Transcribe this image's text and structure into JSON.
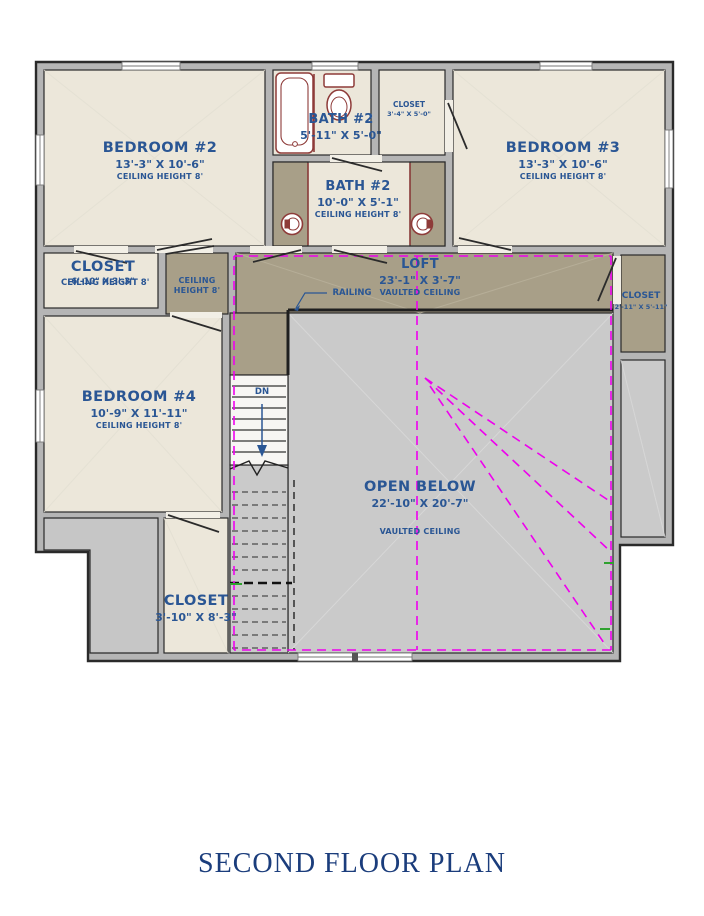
{
  "title": "SECOND FLOOR PLAN",
  "colors": {
    "wall_fill": "#B5B5B5",
    "wall_stroke": "#2A2A2A",
    "room_cream": "#ECE7DA",
    "loft_brown": "#A89F88",
    "open_gray": "#CACACA",
    "label_blue": "#2A5694",
    "title_blue": "#1B3D7C",
    "vault_magenta": "#EE00EE",
    "fixture_red": "#8E3B39",
    "mark_green": "#2FA12F"
  },
  "rooms": {
    "bedroom2": {
      "name": "BEDROOM #2",
      "dims": "13'-3\" X 10'-6\"",
      "ceiling": "CEILING HEIGHT 8'"
    },
    "bath2_upper": {
      "name": "BATH #2",
      "dims": "5'-11\" X 5'-0\""
    },
    "closet_upper": {
      "name": "CLOSET",
      "dims": "3'-4\" X 5'-0\""
    },
    "bedroom3": {
      "name": "BEDROOM #3",
      "dims": "13'-3\" X 10'-6\"",
      "ceiling": "CEILING HEIGHT 8'"
    },
    "bath2_main": {
      "name": "BATH #2",
      "dims": "10'-0\" X 5'-1\"",
      "ceiling": "CEILING HEIGHT 8'"
    },
    "closet_left": {
      "name": "CLOSET",
      "dims": "6'-10\" X 3'-3\"",
      "ceiling": "CEILING HEIGHT 8'"
    },
    "hallway": {
      "line1": "CEILING",
      "line2": "HEIGHT 8'"
    },
    "loft": {
      "name": "LOFT",
      "dims": "23'-1\" X 3'-7\"",
      "ceiling": "VAULTED CEILING"
    },
    "closet_right": {
      "name": "CLOSET",
      "dims": "2'-11\" X 5'-11\""
    },
    "bedroom4": {
      "name": "BEDROOM #4",
      "dims": "10'-9\" X 11'-11\"",
      "ceiling": "CEILING HEIGHT 8'"
    },
    "open_below": {
      "name": "OPEN BELOW",
      "dims": "22'-10\" X 20'-7\"",
      "ceiling": "VAULTED CEILING"
    },
    "closet_bottom": {
      "name": "CLOSET",
      "dims": "3'-10\" X 8'-3\""
    }
  },
  "annotations": {
    "railing": "RAILING",
    "down": "DN"
  }
}
